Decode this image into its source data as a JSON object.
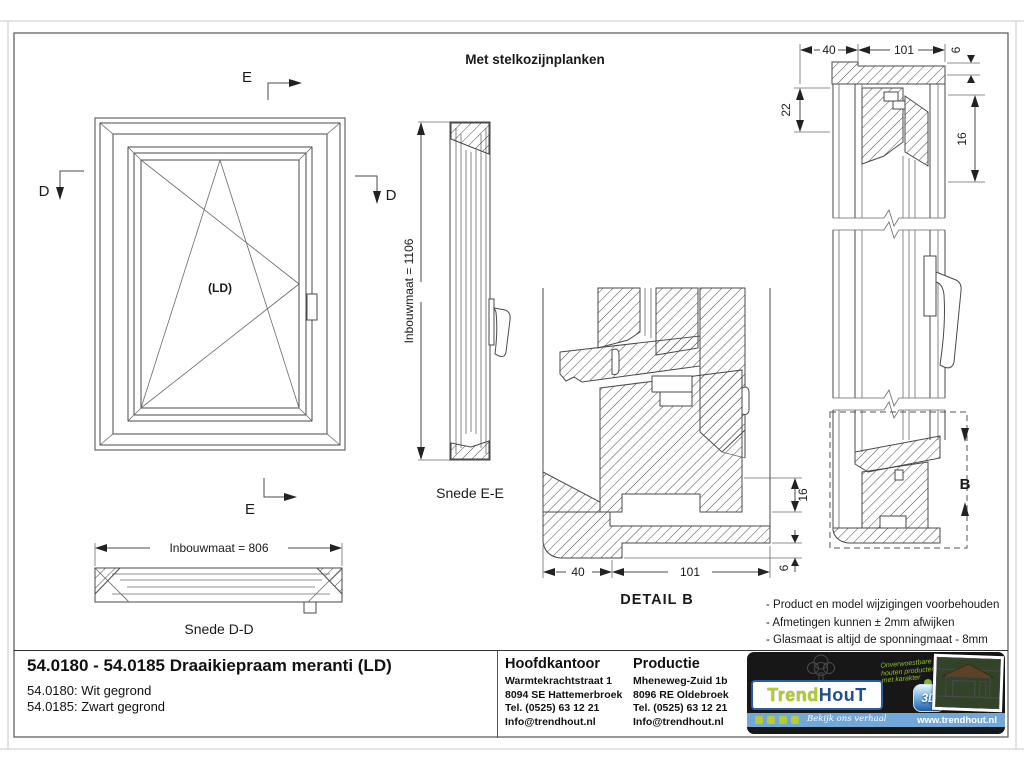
{
  "page": {
    "drawing_title": "Met stelkozijnplanken",
    "notes": [
      "- Product en model wijzigingen voorbehouden",
      "- Afmetingen kunnen ± 2mm afwijken",
      "- Glasmaat is altijd de sponningmaat - 8mm"
    ]
  },
  "views": {
    "elevation": {
      "swing_label": "(LD)"
    },
    "markers": {
      "d": "D",
      "e": "E",
      "b": "B"
    },
    "section_ee": {
      "caption": "Snede E-E",
      "dim_height": "Inbouwmaat = 1106"
    },
    "section_dd": {
      "caption": "Snede D-D",
      "dim_width": "Inbouwmaat = 806"
    },
    "detail_b": {
      "caption": "DETAIL  B",
      "dim_40": "40",
      "dim_101": "101",
      "dim_16": "16",
      "dim_6": "6"
    },
    "head_section": {
      "dim_40": "40",
      "dim_101": "101",
      "dim_6": "6",
      "dim_22": "22",
      "dim_16": "16"
    }
  },
  "titleblock": {
    "product_title": "54.0180 - 54.0185 Draaikiepraam meranti (LD)",
    "variant_1": "54.0180: Wit gegrond",
    "variant_2": "54.0185: Zwart gegrond",
    "hoofdkantoor": {
      "heading": "Hoofdkantoor",
      "address_1": "Warmtekrachtstraat 1",
      "address_2": "8094 SE Hattemerbroek",
      "phone": "Tel. (0525) 63 12 21",
      "email": "Info@trendhout.nl"
    },
    "productie": {
      "heading": "Productie",
      "address_1": "Mheneweg-Zuid 1b",
      "address_2": "8096 RE Oldebroek",
      "phone": "Tel. (0525) 63 12 21",
      "email": "Info@trendhout.nl"
    }
  },
  "brand": {
    "name_part1": "Trend",
    "name_part2": "HouT",
    "tagline_line1": "Onverwoestbare",
    "tagline_line2": "houten producten",
    "tagline_line3": "met karakter",
    "badge_3d": "3D",
    "social_cta": "Bekijk ons verhaal",
    "website": "www.trendhout.nl",
    "colors": {
      "green": "#b5cc2e",
      "blue": "#1d4f91",
      "bar_blue": "#72a7da",
      "panel_black": "#171717"
    }
  }
}
